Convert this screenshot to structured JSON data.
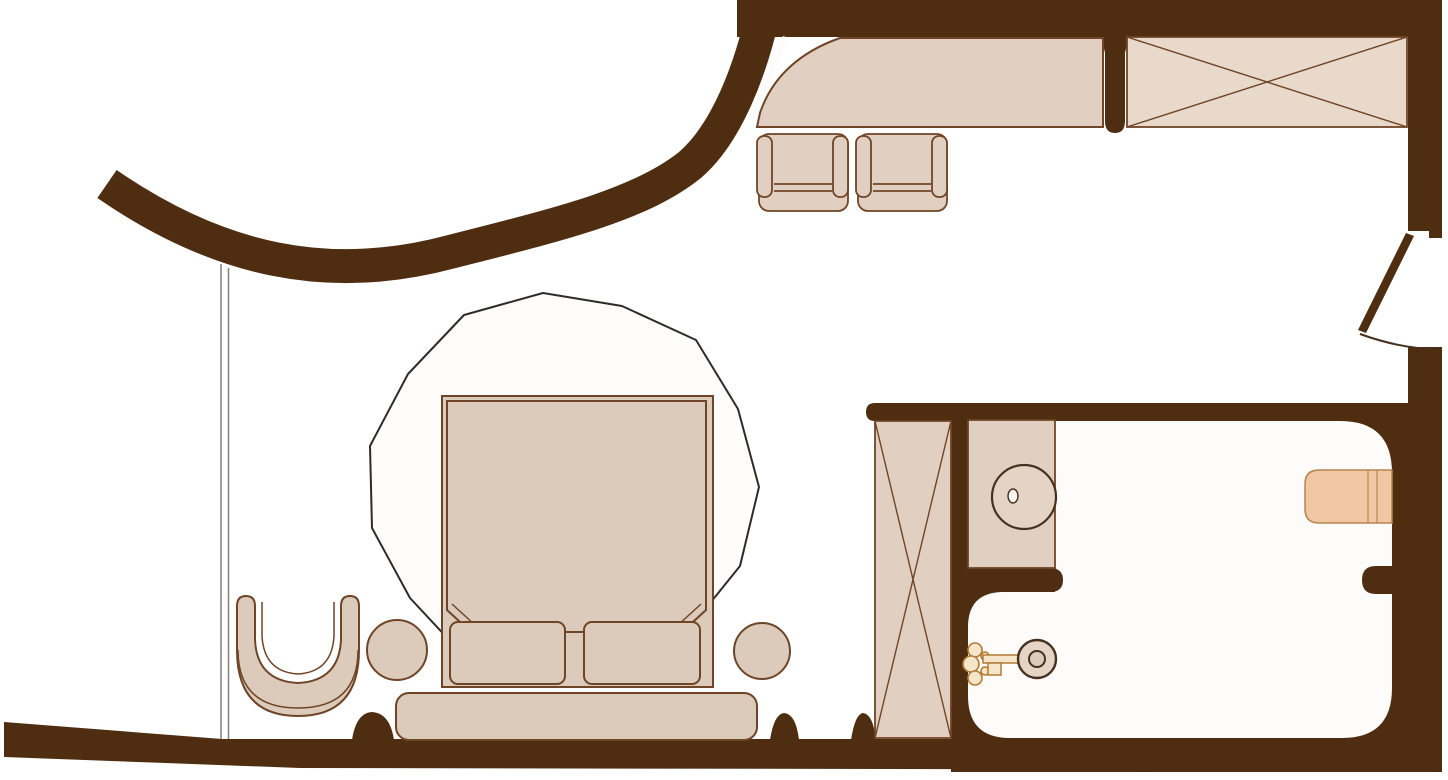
{
  "drawing": {
    "type": "architectural-floor-plan",
    "subject": "hotel-room-suite-plan",
    "fixtures": [
      "curved-entry-wall",
      "entry-door-opening",
      "console-desk",
      "desk-chair-left",
      "desk-chair-right",
      "wardrobe-with-cross",
      "interior-swing-door",
      "window-wall",
      "area-rug",
      "double-bed",
      "duvet",
      "pillow-left",
      "pillow-right",
      "foot-bench",
      "side-table-left",
      "side-table-right",
      "armchair",
      "shower-cabinet",
      "vanity-counter",
      "sink-basin",
      "sink-drain",
      "towel-radiator",
      "ornamental-key",
      "wall-pier-bumps"
    ]
  },
  "colors": {
    "wall": "#4e2d10",
    "outline": "#6f4527",
    "outline_dark": "#46311f",
    "furniture": "#dccaba",
    "furniture_light": "#e9d9ca",
    "desk": "#e1cfc1",
    "counter": "#e1d0c2",
    "sink": "#e4d4c6",
    "drain": "#f7f3ee",
    "radiator": "#f1c7a3",
    "radiator_outline": "#b5854f",
    "rug_line": "#2f2b27",
    "rug_fill": "#fefdfb",
    "window_line": "#8e867c",
    "key_gold": "#b07c35",
    "key_light": "#f6e6c9",
    "floor": "#fdfcfa",
    "page_bg": "#ffffff"
  }
}
